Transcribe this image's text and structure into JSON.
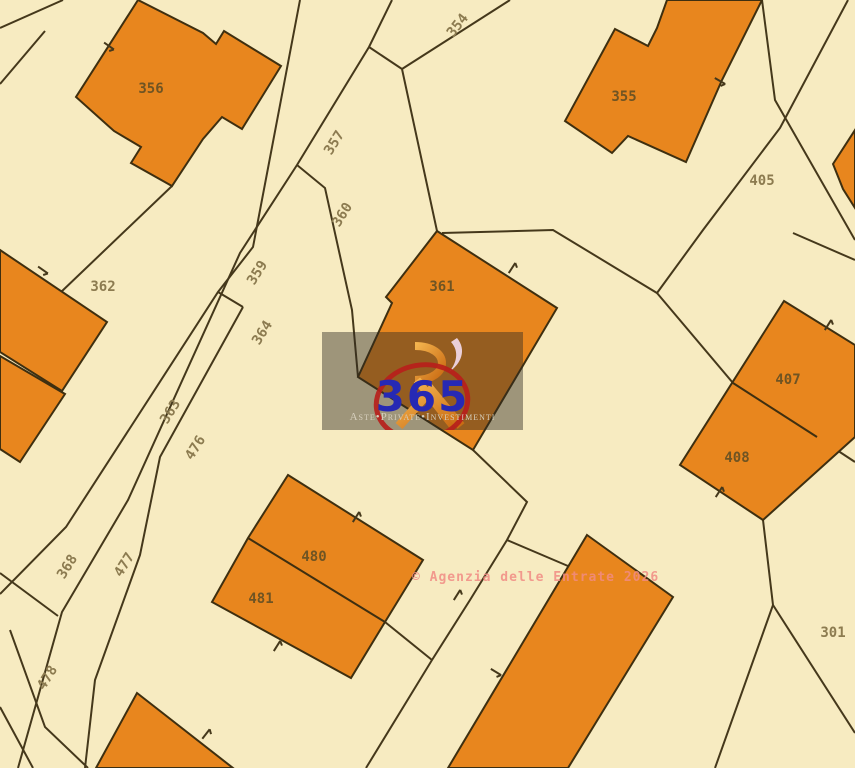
{
  "copyright": "© Agenzia delle Entrate 2026",
  "watermark": {
    "number": "365",
    "tagline": "Aste•Private•Investimenti"
  },
  "colors": {
    "background": "#f7ebc1",
    "parcel_line": "#45381b",
    "building_fill": "#e8861e",
    "building_stroke": "#3e2f10",
    "label_ground": "#8c7b50",
    "label_building": "#6f5423",
    "copyright_pink": "#f18b84",
    "watermark_blue": "#2629b4",
    "watermark_red": "#b71f1b",
    "logo_orange": "#e08a20"
  },
  "map": {
    "labels": [
      {
        "t": "356",
        "x": 151,
        "y": 93,
        "rot": 0,
        "on": "building"
      },
      {
        "t": "354",
        "x": 461,
        "y": 28,
        "rot": -52,
        "on": "ground"
      },
      {
        "t": "357",
        "x": 338,
        "y": 145,
        "rot": -58,
        "on": "ground"
      },
      {
        "t": "360",
        "x": 346,
        "y": 217,
        "rot": -58,
        "on": "ground"
      },
      {
        "t": "359",
        "x": 261,
        "y": 275,
        "rot": -58,
        "on": "ground"
      },
      {
        "t": "364",
        "x": 266,
        "y": 335,
        "rot": -58,
        "on": "ground"
      },
      {
        "t": "362",
        "x": 103,
        "y": 291,
        "rot": 0,
        "on": "ground"
      },
      {
        "t": "363",
        "x": 174,
        "y": 414,
        "rot": -58,
        "on": "ground"
      },
      {
        "t": "476",
        "x": 199,
        "y": 450,
        "rot": -58,
        "on": "ground"
      },
      {
        "t": "368",
        "x": 71,
        "y": 569,
        "rot": -58,
        "on": "ground"
      },
      {
        "t": "477",
        "x": 128,
        "y": 567,
        "rot": -58,
        "on": "ground"
      },
      {
        "t": "478",
        "x": 51,
        "y": 680,
        "rot": -58,
        "on": "ground"
      },
      {
        "t": "361",
        "x": 442,
        "y": 291,
        "rot": 0,
        "on": "building"
      },
      {
        "t": "355",
        "x": 624,
        "y": 101,
        "rot": 0,
        "on": "building"
      },
      {
        "t": "405",
        "x": 762,
        "y": 185,
        "rot": 0,
        "on": "ground"
      },
      {
        "t": "407",
        "x": 788,
        "y": 384,
        "rot": 0,
        "on": "building"
      },
      {
        "t": "408",
        "x": 737,
        "y": 462,
        "rot": 0,
        "on": "building"
      },
      {
        "t": "480",
        "x": 314,
        "y": 561,
        "rot": 0,
        "on": "building"
      },
      {
        "t": "481",
        "x": 261,
        "y": 603,
        "rot": 0,
        "on": "building"
      },
      {
        "t": "301",
        "x": 833,
        "y": 637,
        "rot": 0,
        "on": "ground"
      }
    ],
    "buildings": [
      {
        "id": "356",
        "pts": [
          [
            138,
            0
          ],
          [
            203,
            33
          ],
          [
            216,
            44
          ],
          [
            224,
            31
          ],
          [
            281,
            66
          ],
          [
            242,
            129
          ],
          [
            222,
            117
          ],
          [
            203,
            139
          ],
          [
            172,
            186
          ],
          [
            131,
            163
          ],
          [
            141,
            147
          ],
          [
            114,
            131
          ],
          [
            76,
            97
          ]
        ]
      },
      {
        "id": "355",
        "pts": [
          [
            615,
            29
          ],
          [
            648,
            46
          ],
          [
            657,
            28
          ],
          [
            667,
            0
          ],
          [
            762,
            0
          ],
          [
            722,
            80
          ],
          [
            686,
            162
          ],
          [
            628,
            136
          ],
          [
            612,
            153
          ],
          [
            565,
            121
          ]
        ]
      },
      {
        "id": "361",
        "pts": [
          [
            437,
            231
          ],
          [
            557,
            308
          ],
          [
            473,
            450
          ],
          [
            358,
            377
          ],
          [
            392,
            303
          ],
          [
            386,
            297
          ]
        ]
      },
      {
        "id": "362-upper",
        "pts": [
          [
            0,
            250
          ],
          [
            107,
            322
          ],
          [
            62,
            391
          ],
          [
            0,
            352
          ]
        ]
      },
      {
        "id": "362-lower",
        "pts": [
          [
            0,
            356
          ],
          [
            65,
            394
          ],
          [
            20,
            462
          ],
          [
            0,
            449
          ]
        ]
      },
      {
        "id": "407-408",
        "pts": [
          [
            784,
            301
          ],
          [
            855,
            345
          ],
          [
            855,
            437
          ],
          [
            763,
            520
          ],
          [
            680,
            465
          ]
        ]
      },
      {
        "id": "small-top-right",
        "pts": [
          [
            833,
            164
          ],
          [
            855,
            130
          ],
          [
            855,
            208
          ],
          [
            843,
            189
          ]
        ]
      },
      {
        "id": "480-481",
        "pts": [
          [
            288,
            475
          ],
          [
            423,
            560
          ],
          [
            385,
            622
          ],
          [
            351,
            678
          ],
          [
            212,
            602
          ],
          [
            248,
            538
          ]
        ]
      },
      {
        "id": "bottom-triangle",
        "pts": [
          [
            137,
            693
          ],
          [
            233,
            768
          ],
          [
            96,
            768
          ]
        ]
      },
      {
        "id": "big-diagonal",
        "pts": [
          [
            587,
            535
          ],
          [
            673,
            597
          ],
          [
            568,
            768
          ],
          [
            448,
            768
          ]
        ]
      }
    ],
    "divides": [
      [
        [
          248,
          538
        ],
        [
          385,
          622
        ]
      ],
      [
        [
          733,
          383
        ],
        [
          817,
          437
        ]
      ]
    ],
    "lines": [
      [
        [
          0,
          28
        ],
        [
          63,
          0
        ]
      ],
      [
        [
          0,
          84
        ],
        [
          45,
          31
        ]
      ],
      [
        [
          300,
          0
        ],
        [
          253,
          247
        ],
        [
          218,
          292
        ],
        [
          66,
          527
        ],
        [
          0,
          594
        ]
      ],
      [
        [
          392,
          0
        ],
        [
          369,
          47
        ],
        [
          297,
          165
        ],
        [
          240,
          253
        ],
        [
          128,
          500
        ],
        [
          62,
          612
        ],
        [
          18,
          768
        ]
      ],
      [
        [
          218,
          292
        ],
        [
          243,
          307
        ]
      ],
      [
        [
          243,
          307
        ],
        [
          160,
          457
        ],
        [
          140,
          555
        ],
        [
          95,
          680
        ],
        [
          85,
          768
        ]
      ],
      [
        [
          297,
          165
        ],
        [
          325,
          188
        ],
        [
          352,
          310
        ],
        [
          358,
          377
        ]
      ],
      [
        [
          369,
          47
        ],
        [
          402,
          69
        ],
        [
          437,
          231
        ]
      ],
      [
        [
          402,
          69
        ],
        [
          510,
          0
        ]
      ],
      [
        [
          473,
          450
        ],
        [
          527,
          502
        ],
        [
          507,
          540
        ],
        [
          470,
          600
        ],
        [
          432,
          660
        ],
        [
          366,
          768
        ]
      ],
      [
        [
          385,
          622
        ],
        [
          432,
          660
        ]
      ],
      [
        [
          507,
          540
        ],
        [
          568,
          566
        ]
      ],
      [
        [
          442,
          233
        ],
        [
          553,
          230
        ],
        [
          657,
          293
        ],
        [
          703,
          230
        ],
        [
          780,
          128
        ],
        [
          848,
          0
        ]
      ],
      [
        [
          762,
          0
        ],
        [
          775,
          100
        ],
        [
          855,
          240
        ]
      ],
      [
        [
          793,
          233
        ],
        [
          855,
          260
        ]
      ],
      [
        [
          657,
          293
        ],
        [
          733,
          383
        ]
      ],
      [
        [
          817,
          437
        ],
        [
          855,
          462
        ]
      ],
      [
        [
          763,
          520
        ],
        [
          773,
          605
        ],
        [
          715,
          768
        ]
      ],
      [
        [
          773,
          605
        ],
        [
          855,
          733
        ]
      ],
      [
        [
          0,
          573
        ],
        [
          58,
          616
        ]
      ],
      [
        [
          10,
          630
        ],
        [
          45,
          727
        ],
        [
          88,
          768
        ]
      ],
      [
        [
          0,
          707
        ],
        [
          33,
          768
        ]
      ],
      [
        [
          172,
          186
        ],
        [
          60,
          293
        ]
      ]
    ],
    "ticks": [
      [
        109,
        46,
        35
      ],
      [
        43,
        270,
        35
      ],
      [
        720,
        81,
        30
      ],
      [
        512,
        268,
        -57
      ],
      [
        828,
        325,
        -58
      ],
      [
        719,
        492,
        -57
      ],
      [
        356,
        517,
        -58
      ],
      [
        277,
        646,
        -58
      ],
      [
        496,
        672,
        31
      ],
      [
        206,
        734,
        -52
      ],
      [
        457,
        595,
        -58
      ]
    ]
  }
}
